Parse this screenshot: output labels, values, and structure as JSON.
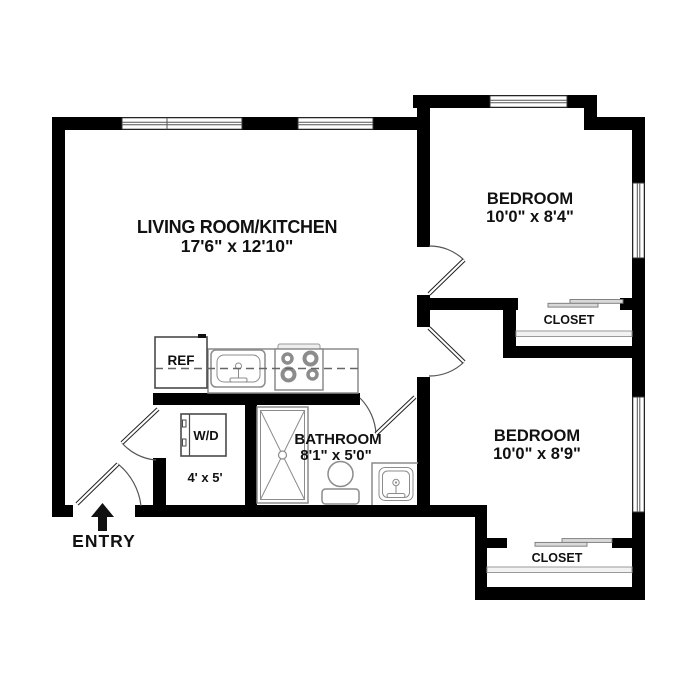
{
  "title": "Apartment Floor Plan",
  "colors": {
    "wall": "#000000",
    "fixture_outline": "#8c8c8c",
    "door_swing": "#555555",
    "background": "#ffffff",
    "text": "#111111"
  },
  "rooms": {
    "living_kitchen": {
      "label": "LIVING ROOM/KITCHEN",
      "dimensions": "17'6\" x 12'10\""
    },
    "bedroom_top": {
      "label": "BEDROOM",
      "dimensions": "10'0\" x 8'4\""
    },
    "bedroom_bottom": {
      "label": "BEDROOM",
      "dimensions": "10'0\" x 8'9\""
    },
    "bathroom": {
      "label": "BATHROOM",
      "dimensions": "8'1\" x 5'0\""
    },
    "laundry_closet": {
      "label": "W/D",
      "dimensions": "4' x 5'"
    },
    "closet_top": {
      "label": "CLOSET"
    },
    "closet_bottom": {
      "label": "CLOSET"
    }
  },
  "fixtures": {
    "refrigerator": "REF"
  },
  "entry": {
    "label": "ENTRY"
  }
}
